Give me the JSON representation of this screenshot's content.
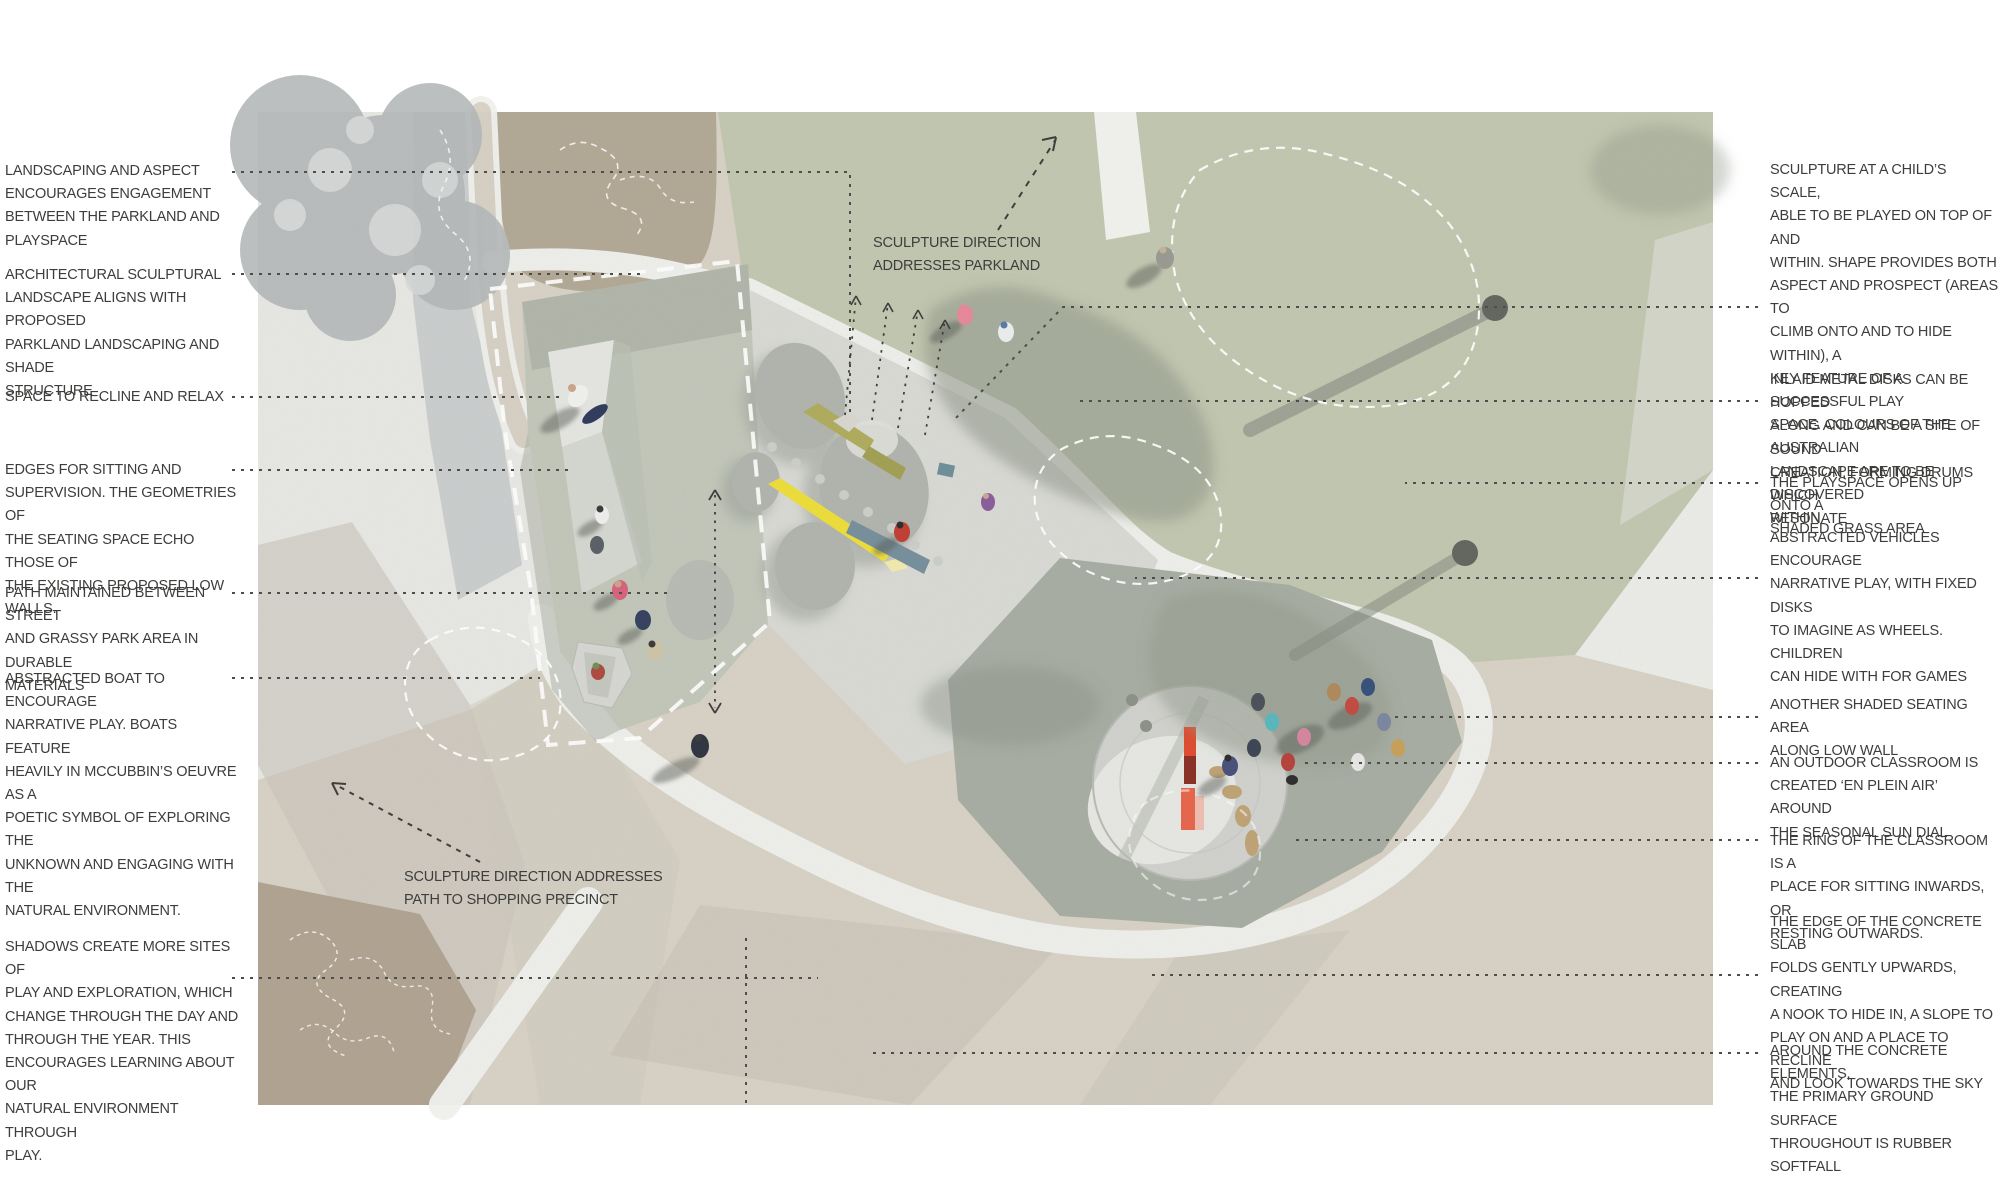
{
  "title": "Playspace annotated masterplan diagram",
  "annotations": {
    "left": [
      {
        "text": "LANDSCAPING AND ASPECT\nENCOURAGES ENGAGEMENT\nBETWEEN THE PARKLAND AND\nPLAYSPACE"
      },
      {
        "text": "ARCHITECTURAL SCULPTURAL\nLANDSCAPE ALIGNS WITH PROPOSED\nPARKLAND LANDSCAPING AND SHADE\nSTRUCTURE"
      },
      {
        "text": "SPACE TO RECLINE AND RELAX"
      },
      {
        "text": "EDGES FOR SITTING AND\nSUPERVISION. THE GEOMETRIES OF\nTHE SEATING SPACE ECHO THOSE OF\nTHE EXISTING PROPOSED LOW\nWALLS."
      },
      {
        "text": "PATH MAINTAINED BETWEEN STREET\nAND GRASSY PARK AREA IN DURABLE\nMATERIALS"
      },
      {
        "text": "ABSTRACTED BOAT TO ENCOURAGE\nNARRATIVE PLAY. BOATS FEATURE\nHEAVILY IN MCCUBBIN’S OEUVRE AS A\nPOETIC SYMBOL OF EXPLORING THE\nUNKNOWN AND ENGAGING WITH THE\nNATURAL ENVIRONMENT."
      },
      {
        "text": "SHADOWS CREATE MORE SITES OF\nPLAY AND EXPLORATION, WHICH\nCHANGE THROUGH THE DAY AND\nTHROUGH THE YEAR. THIS\nENCOURAGES LEARNING ABOUT OUR\nNATURAL ENVIRONMENT THROUGH\nPLAY."
      }
    ],
    "right": [
      {
        "text": "SCULPTURE AT A CHILD’S SCALE,\nABLE TO BE PLAYED ON TOP OF AND\nWITHIN. SHAPE PROVIDES BOTH\nASPECT AND PROSPECT (AREAS TO\nCLIMB ONTO AND TO HIDE WITHIN), A\nKEY FEATURE OF A SUCCESSFUL PLAY\nSPACE. COLOURS OF THE AUSTRALIAN\nLANDSCAPE ARE TO BE DISCOVERED\nWITHIN"
      },
      {
        "text": "INLAID METAL DISKS CAN BE HOPPED\nALONG AND CAN BE A SITE OF SOUND\nCREATION, FORMING DRUMS WHICH\nRESONATE"
      },
      {
        "text": "THE PLAYSPACE OPENS UP ONTO A\nSHADED GRASS AREA"
      },
      {
        "text": "ABSTRACTED VEHICLES ENCOURAGE\nNARRATIVE PLAY, WITH FIXED DISKS\nTO IMAGINE AS WHEELS. CHILDREN\nCAN HIDE WITH FOR GAMES"
      },
      {
        "text": "ANOTHER SHADED SEATING AREA\nALONG LOW WALL"
      },
      {
        "text": "AN OUTDOOR CLASSROOM IS\nCREATED ‘EN PLEIN AIR’ AROUND\nTHE SEASONAL SUN DIAL"
      },
      {
        "text": "THE RING OF THE CLASSROOM IS A\nPLACE FOR SITTING INWARDS, OR\nRESTING OUTWARDS."
      },
      {
        "text": "THE EDGE OF THE CONCRETE SLAB\nFOLDS GENTLY UPWARDS, CREATING\nA NOOK TO HIDE IN, A SLOPE TO\nPLAY ON AND A PLACE TO RECLINE\nAND LOOK TOWARDS THE SKY"
      },
      {
        "text": "AROUND THE CONCRETE ELEMENTS,\nTHE PRIMARY GROUND SURFACE\nTHROUGHOUT IS RUBBER SOFTFALL"
      }
    ],
    "center": [
      {
        "text": "SCULPTURE DIRECTION\nADDRESSES PARKLAND"
      },
      {
        "text": "SCULPTURE DIRECTION ADDRESSES\nPATH TO SHOPPING PRECINCT"
      }
    ]
  },
  "plan_features": [
    "parkland-grass",
    "top-path-strip",
    "street-footpath",
    "tree-canopy",
    "proposed-garden-bed",
    "seating-terrace",
    "recline-slope",
    "abstracted-boat",
    "concrete-slab",
    "sculpture-blobs",
    "colour-bar-olive",
    "colour-bar-yellow",
    "colour-bar-slate",
    "inlaid-metal-disk-trail",
    "rubber-softfall",
    "outdoor-classroom-ring",
    "seasonal-sun-dial",
    "shade-structure-dashed-outline",
    "tree-dashed-outlines",
    "tree-shadows",
    "people-figures"
  ],
  "colors": {
    "page_bg": "#ffffff",
    "annotation_text": "#3d3d3b",
    "leader_line": "#4d4d4b",
    "grass_green": "#c3c8b1",
    "ground_beige": "#d9d3c7",
    "pavement_grey": "#e9e9e5",
    "garden_bed_brown": "#b3a996",
    "terrace_green_grey": "#c3c8bb",
    "concrete_slab": "#dadbd6",
    "rubber_softfall": "#a8aea3",
    "path_white": "#f0f1ed",
    "sundial_red": "#e04b2f",
    "bar_olive": "#b0ad5e",
    "bar_yellow": "#efdf3a",
    "bar_slate": "#76909d",
    "shadow_olive": "#949b8d"
  }
}
